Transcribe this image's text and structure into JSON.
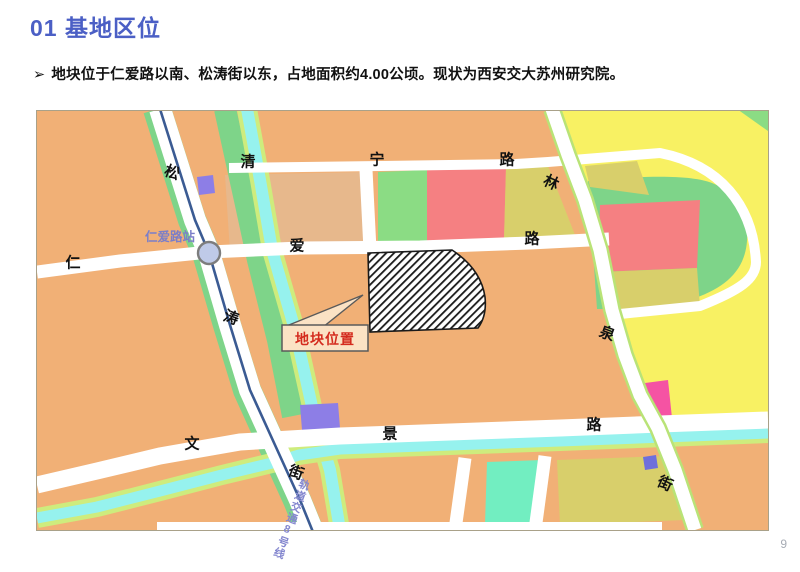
{
  "slide": {
    "title": "01 基地区位",
    "bullet_marker": "➢",
    "bullet_text": "地块位于仁爱路以南、松涛街以东，占地面积约4.00公顷。现状为西安交大苏州研究院。",
    "page_number": "9"
  },
  "map": {
    "station_label": "仁爱路站",
    "metro_line_label": "轨道交通8号线",
    "plot_callout_label": "地块位置",
    "streets": {
      "qingning_road": {
        "name": "清宁路",
        "chars": [
          "清",
          "宁",
          "路"
        ]
      },
      "renai_road": {
        "name": "仁爱路",
        "chars": [
          "仁",
          "爱",
          "路"
        ]
      },
      "wenjing_road": {
        "name": "文景路",
        "chars": [
          "文",
          "景",
          "路"
        ]
      },
      "songtao_street": {
        "name": "松涛街",
        "chars": [
          "松",
          "涛",
          "街"
        ]
      },
      "linquan_street": {
        "name": "林泉街",
        "chars": [
          "林",
          "泉",
          "街"
        ]
      }
    },
    "colors": {
      "land_orange": "#F1B076",
      "land_peach": "#E7B88C",
      "land_yellow": "#F8F163",
      "land_olive": "#D8CF6B",
      "land_green": "#8BDC84",
      "park_green": "#7ED489",
      "land_pink": "#F58082",
      "land_magenta": "#F553A3",
      "land_purple": "#8D7EE6",
      "land_teal": "#72EEC1",
      "canal_cyan": "#96F2EE",
      "canal_edge_green": "#CEEC7D",
      "road_white": "#FFFFFF",
      "metro_blue": "#3B5B93",
      "station_fill": "#BFCAE8",
      "station_text": "#7B7EC8",
      "callout_red": "#D42B1E",
      "callout_bg": "#FBE2C4",
      "title_blue": "#4B5FC5"
    }
  }
}
